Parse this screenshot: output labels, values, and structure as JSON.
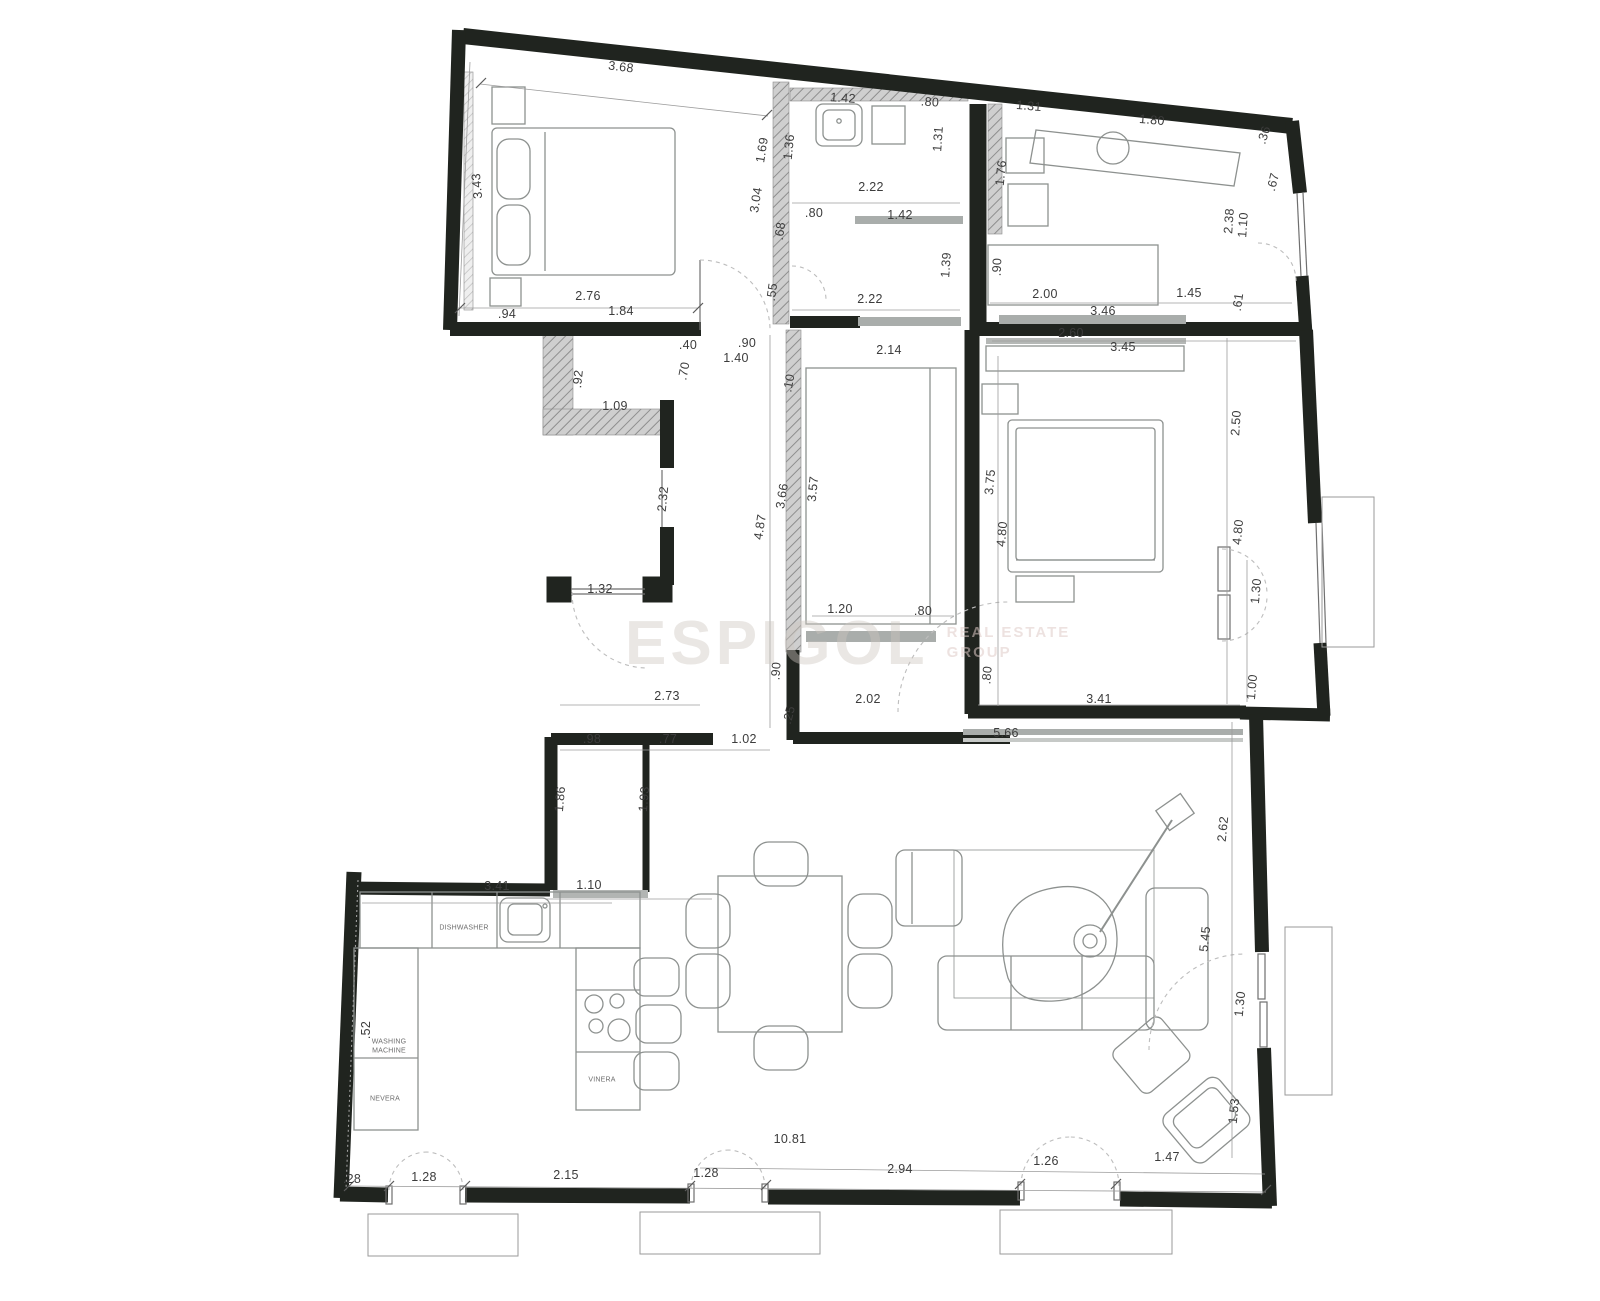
{
  "watermark": {
    "brand": "ESPIGOL",
    "tagline_line1": "REAL ESTATE",
    "tagline_line2": "GROUP"
  },
  "appliance_labels": [
    {
      "text": "DISHWASHER",
      "x": 464,
      "y": 928,
      "r": 0
    },
    {
      "text": "VINERA",
      "x": 602,
      "y": 1080,
      "r": 0
    },
    {
      "text": "NEVERA",
      "x": 385,
      "y": 1099,
      "r": 0
    },
    {
      "text": "WASHING",
      "x": 389,
      "y": 1042,
      "r": 0
    },
    {
      "text": "MACHINE",
      "x": 389,
      "y": 1051,
      "r": 0
    }
  ],
  "dimensions": [
    {
      "t": "3.68",
      "x": 621,
      "y": 67,
      "r": 7
    },
    {
      "t": "3.43",
      "x": 477,
      "y": 186,
      "r": -95
    },
    {
      "t": "2.76",
      "x": 588,
      "y": 296,
      "r": 0
    },
    {
      "t": "1.84",
      "x": 621,
      "y": 311,
      "r": 0
    },
    {
      "t": ".94",
      "x": 507,
      "y": 314,
      "r": 0
    },
    {
      "t": "1.42",
      "x": 843,
      "y": 98,
      "r": 4
    },
    {
      "t": ".80",
      "x": 930,
      "y": 102,
      "r": 4
    },
    {
      "t": "1.69",
      "x": 762,
      "y": 150,
      "r": -81
    },
    {
      "t": "1.36",
      "x": 789,
      "y": 147,
      "r": -84
    },
    {
      "t": "1.31",
      "x": 938,
      "y": 139,
      "r": -86
    },
    {
      "t": "3.04",
      "x": 756,
      "y": 200,
      "r": -81
    },
    {
      "t": "2.22",
      "x": 871,
      "y": 187,
      "r": 0
    },
    {
      "t": ".80",
      "x": 814,
      "y": 213,
      "r": 0
    },
    {
      "t": "1.42",
      "x": 900,
      "y": 215,
      "r": 0
    },
    {
      "t": ".68",
      "x": 780,
      "y": 231,
      "r": -82
    },
    {
      "t": "1.39",
      "x": 946,
      "y": 265,
      "r": -86
    },
    {
      "t": ".55",
      "x": 772,
      "y": 292,
      "r": -82
    },
    {
      "t": "2.22",
      "x": 870,
      "y": 299,
      "r": 0
    },
    {
      "t": "1.31",
      "x": 1029,
      "y": 106,
      "r": 5
    },
    {
      "t": "1.80",
      "x": 1152,
      "y": 120,
      "r": 5
    },
    {
      "t": ".36",
      "x": 1264,
      "y": 135,
      "r": -72
    },
    {
      "t": ".67",
      "x": 1273,
      "y": 182,
      "r": -76
    },
    {
      "t": "1.76",
      "x": 1001,
      "y": 173,
      "r": -84
    },
    {
      "t": "2.38",
      "x": 1229,
      "y": 221,
      "r": -86
    },
    {
      "t": "1.10",
      "x": 1243,
      "y": 225,
      "r": -86
    },
    {
      "t": ".90",
      "x": 997,
      "y": 267,
      "r": -88
    },
    {
      "t": "2.00",
      "x": 1045,
      "y": 294,
      "r": 0
    },
    {
      "t": "1.45",
      "x": 1189,
      "y": 293,
      "r": 0
    },
    {
      "t": ".61",
      "x": 1238,
      "y": 302,
      "r": -82
    },
    {
      "t": "3.46",
      "x": 1103,
      "y": 311,
      "r": 0
    },
    {
      "t": "2.60",
      "x": 1071,
      "y": 333,
      "r": 0
    },
    {
      "t": "3.45",
      "x": 1123,
      "y": 347,
      "r": 0
    },
    {
      "t": ".40",
      "x": 688,
      "y": 345,
      "r": 0
    },
    {
      "t": ".90",
      "x": 747,
      "y": 343,
      "r": 0
    },
    {
      "t": "1.40",
      "x": 736,
      "y": 358,
      "r": 0
    },
    {
      "t": ".70",
      "x": 684,
      "y": 371,
      "r": -79
    },
    {
      "t": "2.14",
      "x": 889,
      "y": 350,
      "r": 0
    },
    {
      "t": ".10",
      "x": 789,
      "y": 383,
      "r": -79
    },
    {
      "t": ".92",
      "x": 578,
      "y": 379,
      "r": -84
    },
    {
      "t": "1.09",
      "x": 615,
      "y": 406,
      "r": 0
    },
    {
      "t": "2.32",
      "x": 663,
      "y": 499,
      "r": -84
    },
    {
      "t": "3.66",
      "x": 782,
      "y": 496,
      "r": -81
    },
    {
      "t": "3.57",
      "x": 813,
      "y": 489,
      "r": -84
    },
    {
      "t": "4.87",
      "x": 760,
      "y": 527,
      "r": -81
    },
    {
      "t": "1.32",
      "x": 600,
      "y": 589,
      "r": 0
    },
    {
      "t": "1.20",
      "x": 840,
      "y": 609,
      "r": 0
    },
    {
      "t": ".80",
      "x": 923,
      "y": 611,
      "r": 0
    },
    {
      "t": "2.50",
      "x": 1236,
      "y": 423,
      "r": -86
    },
    {
      "t": "3.75",
      "x": 990,
      "y": 482,
      "r": -85
    },
    {
      "t": "4.80",
      "x": 1002,
      "y": 534,
      "r": -85
    },
    {
      "t": "4.80",
      "x": 1238,
      "y": 532,
      "r": -85
    },
    {
      "t": "1.30",
      "x": 1256,
      "y": 591,
      "r": -85
    },
    {
      "t": ".90",
      "x": 776,
      "y": 671,
      "r": -86
    },
    {
      "t": ".80",
      "x": 987,
      "y": 675,
      "r": -85
    },
    {
      "t": "2.02",
      "x": 868,
      "y": 699,
      "r": 0
    },
    {
      "t": ".25",
      "x": 789,
      "y": 715,
      "r": -76
    },
    {
      "t": "1.00",
      "x": 1252,
      "y": 687,
      "r": -85
    },
    {
      "t": "3.41",
      "x": 1099,
      "y": 699,
      "r": 0
    },
    {
      "t": "2.73",
      "x": 667,
      "y": 696,
      "r": 0
    },
    {
      "t": "5.66",
      "x": 1006,
      "y": 733,
      "r": 0
    },
    {
      "t": ".98",
      "x": 592,
      "y": 739,
      "r": 0
    },
    {
      "t": ".77",
      "x": 668,
      "y": 739,
      "r": 0
    },
    {
      "t": "1.02",
      "x": 744,
      "y": 739,
      "r": 0
    },
    {
      "t": "1.86",
      "x": 560,
      "y": 799,
      "r": -85
    },
    {
      "t": "1.93",
      "x": 644,
      "y": 799,
      "r": -85
    },
    {
      "t": "3.41",
      "x": 497,
      "y": 886,
      "r": 0
    },
    {
      "t": "1.10",
      "x": 589,
      "y": 885,
      "r": 0
    },
    {
      "t": "2.62",
      "x": 1223,
      "y": 829,
      "r": -84
    },
    {
      "t": "5.45",
      "x": 1205,
      "y": 939,
      "r": -84
    },
    {
      "t": "1.30",
      "x": 1240,
      "y": 1004,
      "r": -84
    },
    {
      "t": "1.53",
      "x": 1234,
      "y": 1111,
      "r": -84
    },
    {
      "t": "10.81",
      "x": 790,
      "y": 1139,
      "r": 0
    },
    {
      "t": ".52",
      "x": 366,
      "y": 1030,
      "r": -90
    },
    {
      "t": ".28",
      "x": 352,
      "y": 1179,
      "r": 0
    },
    {
      "t": "1.28",
      "x": 424,
      "y": 1177,
      "r": 0
    },
    {
      "t": "2.15",
      "x": 566,
      "y": 1175,
      "r": 0
    },
    {
      "t": "1.28",
      "x": 706,
      "y": 1173,
      "r": 0
    },
    {
      "t": "2.94",
      "x": 900,
      "y": 1169,
      "r": 0
    },
    {
      "t": "1.26",
      "x": 1046,
      "y": 1161,
      "r": 0
    },
    {
      "t": "1.47",
      "x": 1167,
      "y": 1157,
      "r": 0
    }
  ]
}
